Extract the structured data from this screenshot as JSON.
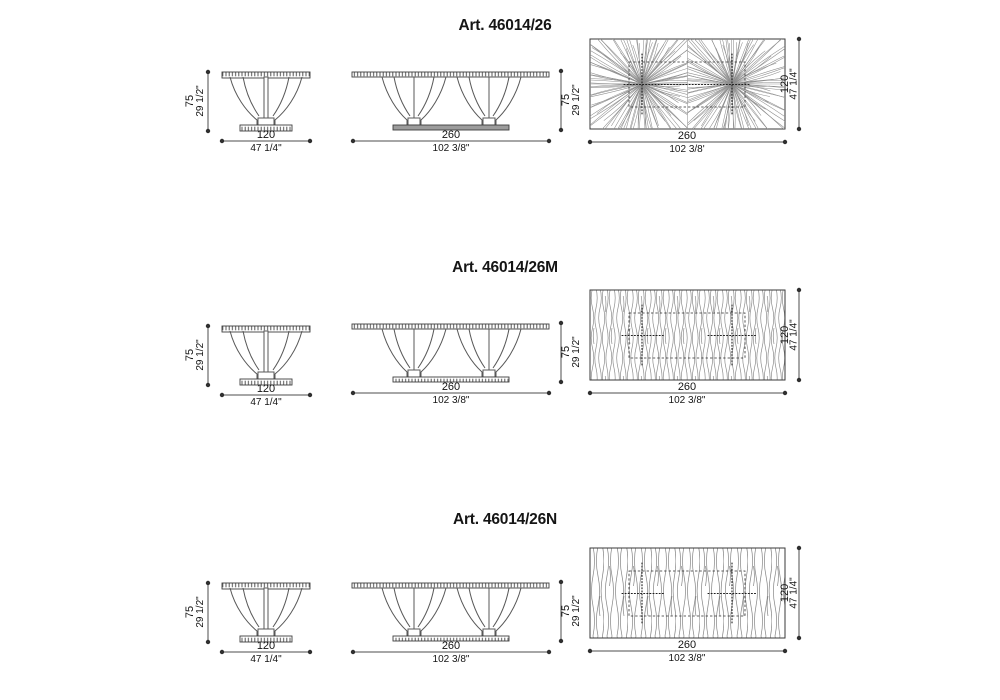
{
  "page": {
    "background": "#ffffff",
    "line_color": "#4d4d4d",
    "text_color": "#141414"
  },
  "rows": [
    {
      "title": "Art. 46014/26",
      "side_view": {
        "height_cm": "75",
        "height_in": "29 1/2\"",
        "width_cm": "120",
        "width_in": "47 1/4\""
      },
      "front_view": {
        "height_cm": "75",
        "height_in": "29 1/2\"",
        "length_cm": "260",
        "length_in": "102 3/8\"",
        "base_style": "solid"
      },
      "top_view": {
        "length_cm": "260",
        "length_in": "102 3/8'",
        "depth_cm": "120",
        "depth_in": "47 1/4\"",
        "grain": "radial"
      }
    },
    {
      "title": "Art. 46014/26M",
      "side_view": {
        "height_cm": "75",
        "height_in": "29 1/2\"",
        "width_cm": "120",
        "width_in": "47 1/4\""
      },
      "front_view": {
        "height_cm": "75",
        "height_in": "29 1/2\"",
        "length_cm": "260",
        "length_in": "102 3/8\"",
        "base_style": "hatched"
      },
      "top_view": {
        "length_cm": "260",
        "length_in": "102 3/8\"",
        "depth_cm": "120",
        "depth_in": "47 1/4\"",
        "grain": "vertical-fine"
      }
    },
    {
      "title": "Art. 46014/26N",
      "side_view": {
        "height_cm": "75",
        "height_in": "29 1/2\"",
        "width_cm": "120",
        "width_in": "47 1/4\""
      },
      "front_view": {
        "height_cm": "75",
        "height_in": "29 1/2\"",
        "length_cm": "260",
        "length_in": "102 3/8\"",
        "base_style": "hatched"
      },
      "top_view": {
        "length_cm": "260",
        "length_in": "102 3/8\"",
        "depth_cm": "120",
        "depth_in": "47 1/4\"",
        "grain": "vertical-coarse"
      }
    }
  ]
}
